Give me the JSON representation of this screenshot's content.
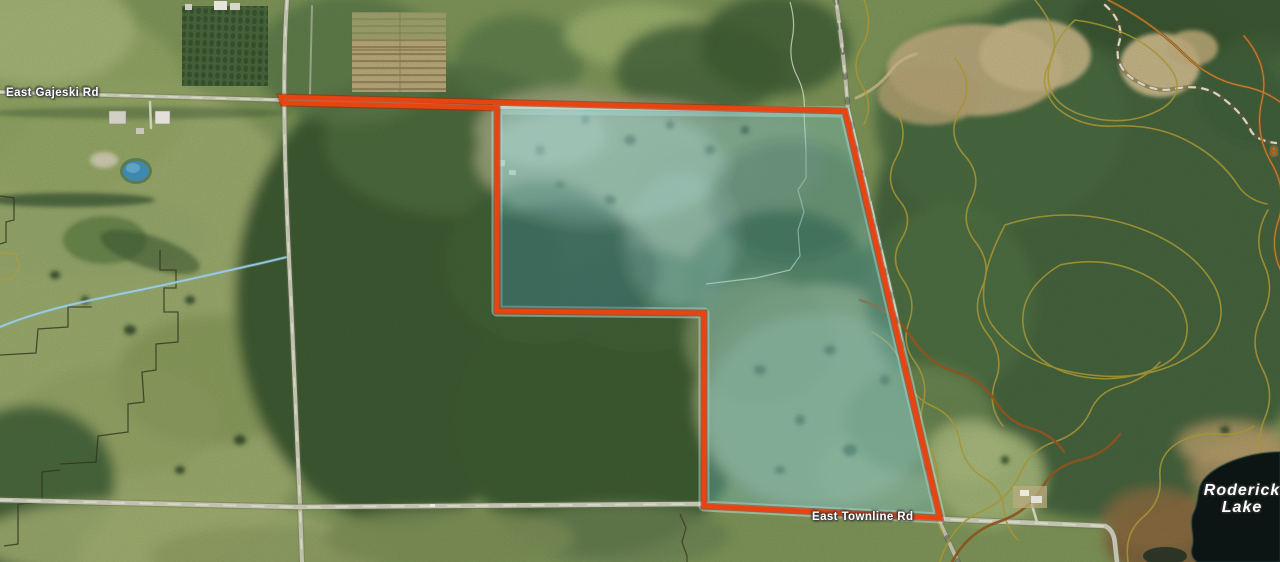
{
  "map": {
    "labels": {
      "road_gajeski": "East Gajeski Rd",
      "road_townline": "East Townline Rd",
      "lake_name": "Roderick Lake",
      "lake_line1": "Roderick",
      "lake_line2": "Lake",
      "elevation_partial": "8"
    },
    "colors": {
      "parcel_outline": "#e9440f",
      "parcel_outline_shadow": "#a32b06",
      "parcel_highlight": "rgba(108,190,200,0.33)",
      "parcel_highlight_rim": "rgba(198,236,229,0.5)",
      "contour_minor": "#a59434",
      "contour_index": "#8a5420",
      "road_surface": "#c2c2b0",
      "stream": "#9cd0ea",
      "lake_water": "#0c1514",
      "label_text": "#ffffff",
      "elevation_label": "#b4560a"
    }
  }
}
